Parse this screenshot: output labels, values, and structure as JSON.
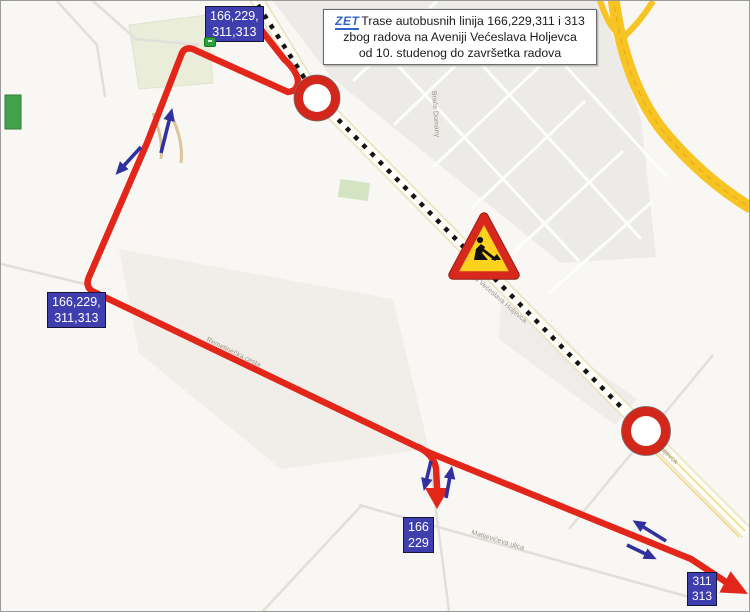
{
  "title_box": {
    "logo": "ZET",
    "line1": "Trase autobusnih linija 166,229,311 i 313",
    "line2": "zbog radova na Aveniji Većeslava Holjevca",
    "line3": "od 10. studenog do završetka radova"
  },
  "route_labels": {
    "top": {
      "line1": "166,229,",
      "line2": "311,313"
    },
    "left": {
      "line1": "166,229,",
      "line2": "311,313"
    },
    "bottom_center": {
      "line1": "166",
      "line2": "229"
    },
    "bottom_right": {
      "line1": "311",
      "line2": "313"
    }
  },
  "street_labels": {
    "avenue": "Avenija Većeslava Holjevca",
    "avenue_south": "Holjevca",
    "diagonal": "Remetinečka cesta",
    "bottom_street": "Matijevićeva ulica",
    "block_street": "Braće Domany"
  },
  "icons": {
    "zet_logo": "zet-logo",
    "roadworks": "roadworks-sign",
    "road_closed_top": "road-closed-sign",
    "road_closed_bottom": "road-closed-sign",
    "bus_stop": "bus-stop-icon",
    "direction_arrows": "direction-arrow-icon"
  },
  "colors": {
    "route_red": "#e2261a",
    "arrow_blue": "#30309f",
    "label_bg": "#3e3eae",
    "closure_ring_red": "#d3271c",
    "sign_yellow": "#ffd21e",
    "highway_yellow": "#f7c423",
    "dotted_black": "#141414"
  }
}
